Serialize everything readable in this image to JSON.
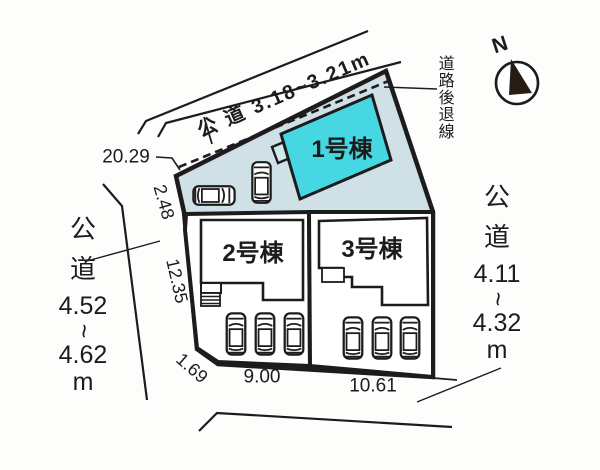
{
  "plan_type": "site-plan",
  "north_indicator": {
    "label": "N"
  },
  "roads": {
    "top": {
      "label": "公 道 3.18~3.21m"
    },
    "left": {
      "lines": [
        "公",
        "道",
        "4.52",
        "~",
        "4.62",
        "m"
      ]
    },
    "right": {
      "lines": [
        "公",
        "道",
        "4.11",
        "~",
        "4.32",
        "m"
      ]
    }
  },
  "setback": {
    "label": "道路後退線"
  },
  "dims": {
    "n2029": "20.29",
    "n248": "2.48",
    "n1235": "12.35",
    "n169": "1.69",
    "n900": "9.00",
    "n1061": "10.61"
  },
  "buildings": {
    "b1": "1号棟",
    "b2": "2号棟",
    "b3": "3号棟"
  },
  "colors": {
    "building1_fill": "#47d7e2",
    "building1_annex_fill": "#cfe9ec",
    "ground_fill": "#cfe0e6",
    "line": "#1c1c1c"
  }
}
